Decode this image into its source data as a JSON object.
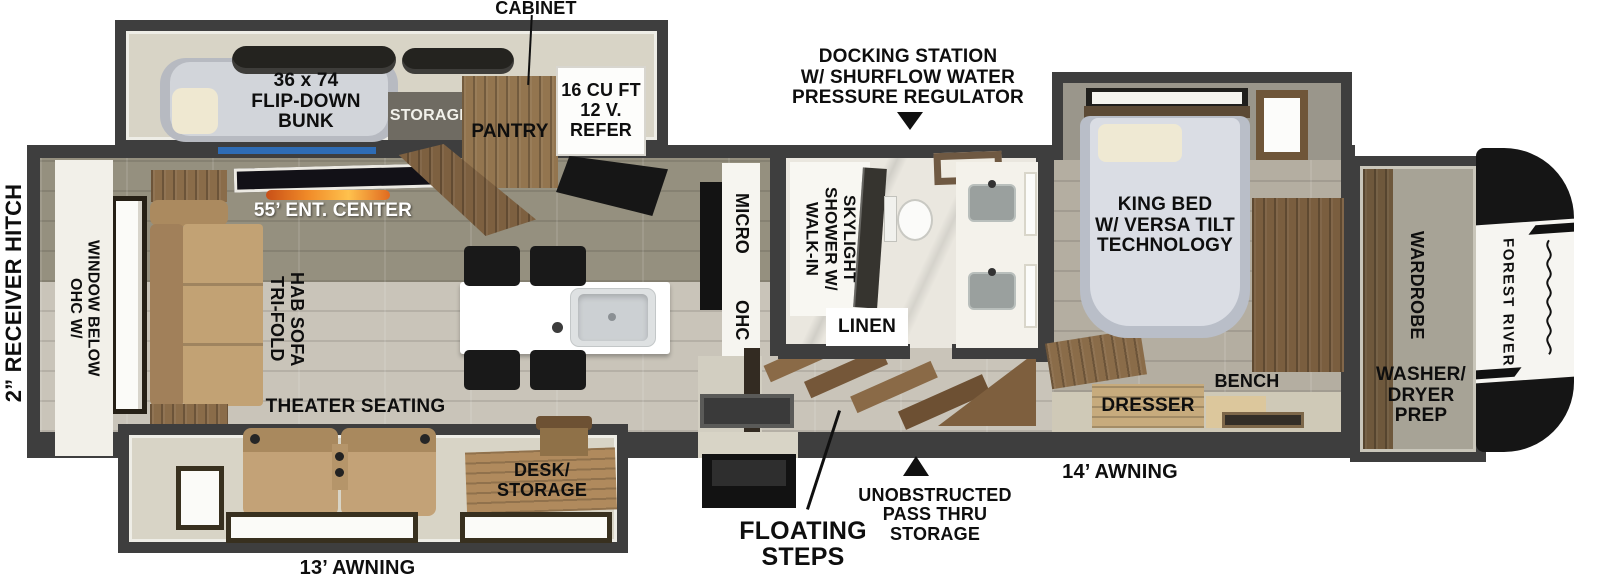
{
  "colors": {
    "wall": "#3e3e3e",
    "slide_floor": "#d8d4c6",
    "tile_dark": "#95907f",
    "tile_light": "#c9c4b9",
    "bedroom_tile": "#b4aea1",
    "wood": "#8a6c49",
    "sofa_tan": "#c2a274",
    "accent_blue": "#2e6cb5",
    "flame_orange": "#f08a28",
    "bed_gray": "#dadde4",
    "cap_black": "#151515"
  },
  "callouts": {
    "cabinet": "CABINET",
    "docking_station": "DOCKING STATION\nW/ SHURFLOW WATER\nPRESSURE REGULATOR",
    "receiver_hitch": "2” RECEIVER HITCH",
    "floating_steps": "FLOATING\nSTEPS",
    "pass_thru_storage": "UNOBSTRUCTED\nPASS THRU\nSTORAGE",
    "awning_13": "13’ AWNING",
    "awning_14": "14’ AWNING"
  },
  "bunk_room": {
    "flip_down_bunk": "36 x 74\nFLIP-DOWN\nBUNK",
    "storage": "STORAGE",
    "pantry": "PANTRY",
    "refer": "16 CU FT\n12 V.\nREFER"
  },
  "living_area": {
    "ent_center": "55’ ENT. CENTER",
    "sofa": "TRI-FOLD\nHAB SOFA",
    "ohc_window": "OHC W/\nWINDOW BELOW",
    "theater_seating": "THEATER SEATING",
    "desk_storage": "DESK/\nSTORAGE"
  },
  "kitchen": {
    "micro": "MICRO",
    "ohc": "OHC"
  },
  "bathroom": {
    "walk_in_shower": "WALK-IN\nSHOWER W/\nSKYLIGHT",
    "linen": "LINEN"
  },
  "bedroom": {
    "king_bed": "KING BED\nW/ VERSA TILT\nTECHNOLOGY",
    "dresser": "DRESSER",
    "bench": "BENCH"
  },
  "front": {
    "wardrobe": "WARDROBE",
    "washer_dryer_prep": "WASHER/\nDRYER\nPREP",
    "brand": "FOREST RIVER"
  }
}
